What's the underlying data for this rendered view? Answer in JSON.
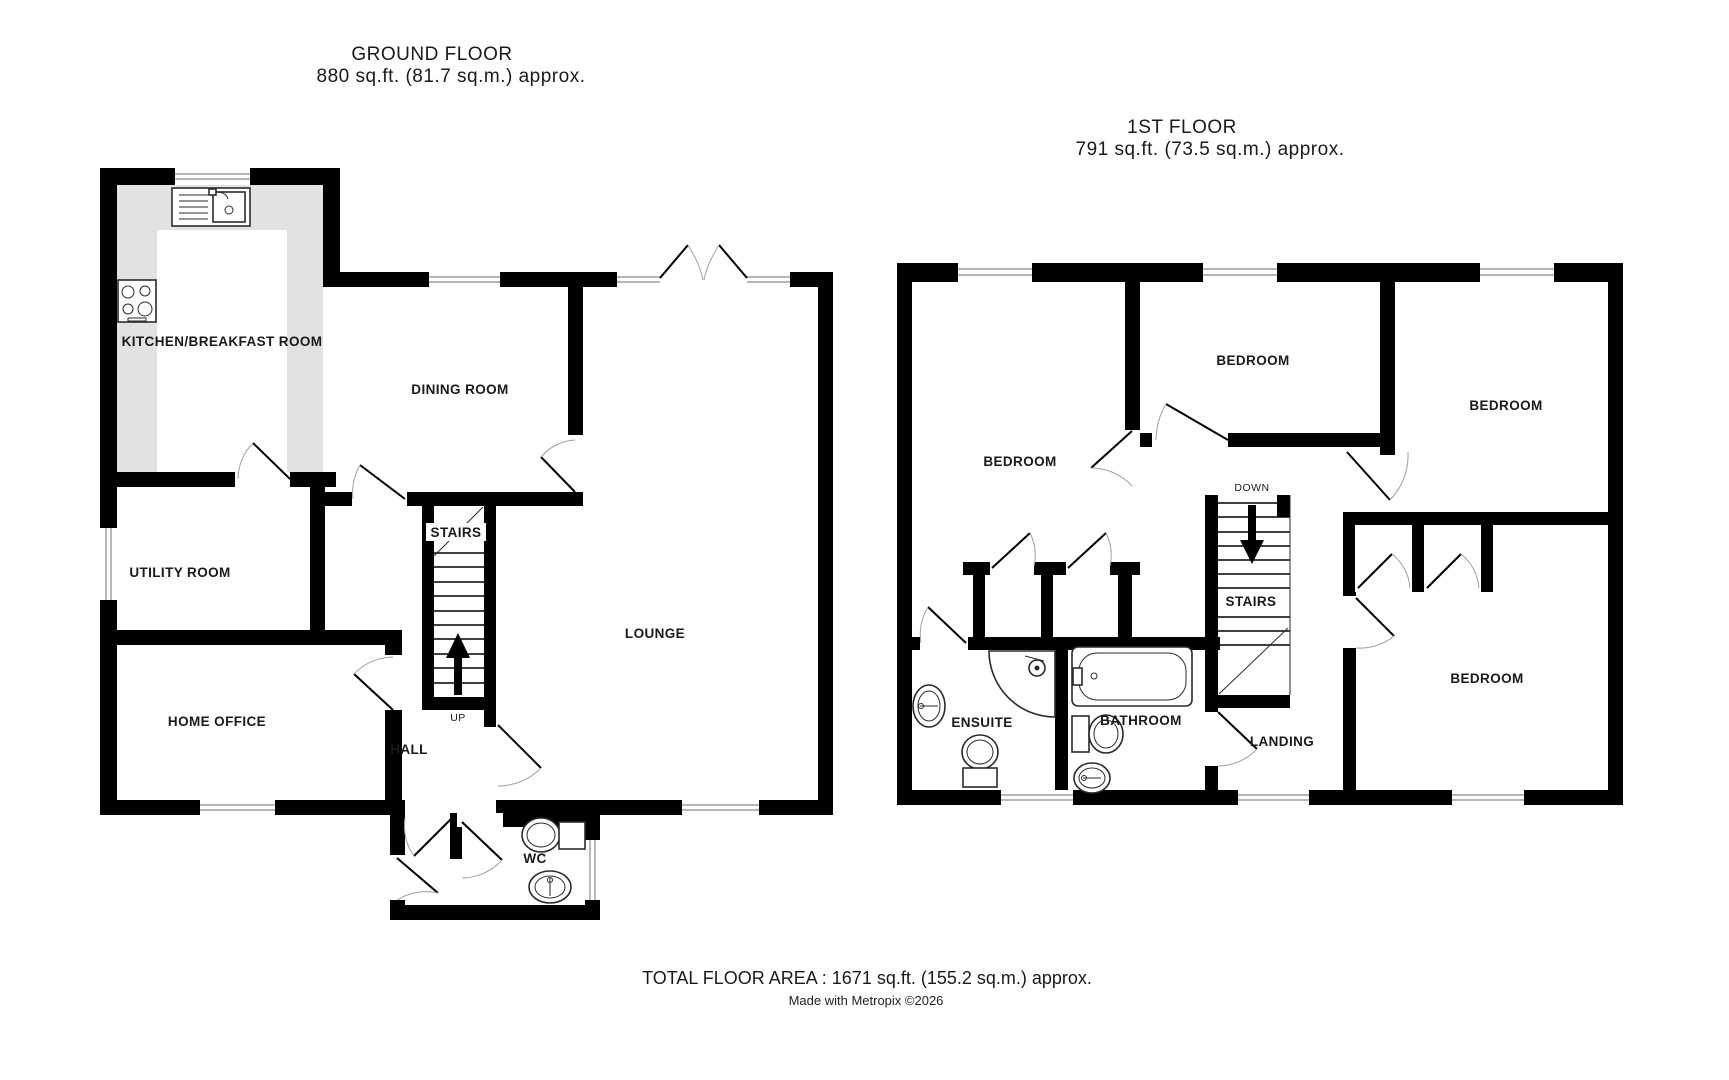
{
  "ground_floor": {
    "title": "GROUND FLOOR",
    "area_line": "880 sq.ft. (81.7 sq.m.) approx.",
    "labels": {
      "kitchen": "KITCHEN/BREAKFAST ROOM",
      "dining": "DINING ROOM",
      "utility": "UTILITY ROOM",
      "stairs": "STAIRS",
      "up": "UP",
      "lounge": "LOUNGE",
      "home_office": "HOME OFFICE",
      "hall": "HALL",
      "wc": "WC"
    }
  },
  "first_floor": {
    "title": "1ST FLOOR",
    "area_line": "791 sq.ft. (73.5 sq.m.) approx.",
    "labels": {
      "bedroom_left": "BEDROOM",
      "bedroom_middle": "BEDROOM",
      "bedroom_right": "BEDROOM",
      "bedroom_bottom": "BEDROOM",
      "stairs": "STAIRS",
      "down": "DOWN",
      "ensuite": "ENSUITE",
      "bathroom": "BATHROOM",
      "landing": "LANDING"
    }
  },
  "footer": {
    "total_area": "TOTAL FLOOR AREA : 1671 sq.ft. (155.2 sq.m.) approx.",
    "credit": "Made with Metropix ©2026"
  },
  "colors": {
    "wall": "#000000",
    "counter": "#e2e2e2",
    "fixture": "#2b2b2b",
    "arc": "#a0a0a0",
    "window_line": "#8a8a8a"
  }
}
